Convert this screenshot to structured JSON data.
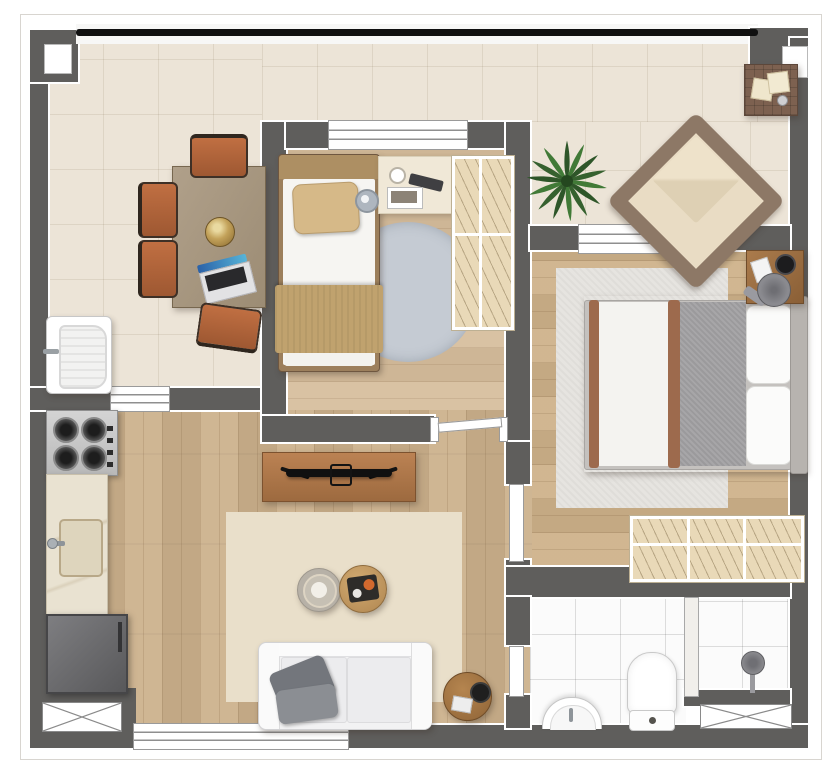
{
  "meta": {
    "type": "floor-plan",
    "view": "top-down-furnished-render",
    "visible_text": []
  },
  "palette": {
    "background": "#ffffff",
    "wall": "#5f5e5c",
    "wall_outline": "#ffffff",
    "railing_black": "#101010",
    "terrace_tile": "#ece4d7",
    "living_wood": "#ccb18c",
    "bedroom_wood": "#d6bd9c",
    "master_wood": "#ceb28a",
    "bathroom_tile": "#fbfbfb",
    "rug_living": "#e9dfca",
    "rug_bedroom_round": "#c5cbd3",
    "rug_master": "#e6e4e0",
    "sofa_white": "#f2f2f3",
    "pillow_gray": "#7b7e83",
    "chair_terracotta": "#b2653c",
    "table_wood": "#a79681",
    "console_wood": "#b0774b",
    "bed_tan": "#c0a26e",
    "blanket_gray": "#9b9a9c",
    "sheet_trim_brown": "#9d6a4d",
    "wardrobe_fill": "#e9d9b8",
    "plant_green": "#36612f",
    "appliance_steel": "#c9c9c9",
    "fridge_gray": "#6b6b6d",
    "fixture_white": "#ffffff"
  },
  "labels": {
    "plan": "apartment floor plan",
    "terrace": "wrap-around terrace",
    "dining_table": "dining table",
    "dining_chair": "dining chair",
    "decor_bowl": "decor bowl",
    "laptop": "laptop",
    "laundry_tub": "laundry tub",
    "plant": "potted plant",
    "armchair": "lounge armchair",
    "side_table": "terrace side table",
    "bedroom": "second bedroom",
    "single_bed": "single bed",
    "bedside_console": "bedside console",
    "alarm_clock": "alarm clock",
    "wardrobe": "wardrobe",
    "round_rug": "round rug",
    "master_bedroom": "master bedroom",
    "double_bed": "double bed",
    "nightstand": "nightstand",
    "master_rug": "area rug",
    "living_room": "living room",
    "tv_console": "tv console",
    "tv": "television",
    "living_rug": "area rug",
    "coffee_table": "coffee table",
    "sofa": "sofa",
    "sofa_side_table": "round side table",
    "kitchen": "kitchen",
    "cooktop": "gas cooktop",
    "sink_counter": "counter with sink",
    "fridge": "refrigerator",
    "bathroom": "bathroom",
    "bath_sink": "bathroom sink",
    "toilet": "toilet",
    "shower": "shower",
    "shaft": "ventilation shaft",
    "window": "sliding window",
    "door": "door",
    "railing": "glass railing"
  },
  "rooms": [
    {
      "id": "terrace",
      "floor": "cream-tile",
      "furniture": [
        "dining-table",
        "dining-chairs-x4",
        "decor-bowl",
        "laptop",
        "laundry-tub",
        "potted-plant",
        "lounge-armchair",
        "side-table"
      ]
    },
    {
      "id": "bedroom-2",
      "floor": "wood",
      "furniture": [
        "single-bed",
        "pillow",
        "blanket",
        "bedside-console",
        "alarm-clock",
        "wardrobe",
        "round-rug"
      ]
    },
    {
      "id": "master-bedroom",
      "floor": "wood",
      "furniture": [
        "double-bed",
        "pillows-x2",
        "nightstand",
        "wardrobe",
        "area-rug"
      ]
    },
    {
      "id": "living-room",
      "floor": "wood",
      "furniture": [
        "tv-console",
        "tv",
        "area-rug",
        "coffee-tables-x2",
        "sofa",
        "gray-pillows-x2",
        "round-side-table"
      ]
    },
    {
      "id": "kitchen",
      "floor": "wood",
      "furniture": [
        "gas-cooktop",
        "counter-with-sink",
        "refrigerator"
      ]
    },
    {
      "id": "bathroom",
      "floor": "white-tile",
      "furniture": [
        "half-round-sink",
        "toilet",
        "shower-box"
      ]
    }
  ],
  "openings": {
    "windows": [
      "bedroom-sliding-window",
      "master-sliding-window",
      "living-bottom-window",
      "service-pass-through"
    ],
    "doors": [
      "bedroom-door",
      "master-door",
      "bathroom-door"
    ],
    "shafts": [
      "bottom-left-shaft",
      "bottom-right-shaft"
    ]
  }
}
